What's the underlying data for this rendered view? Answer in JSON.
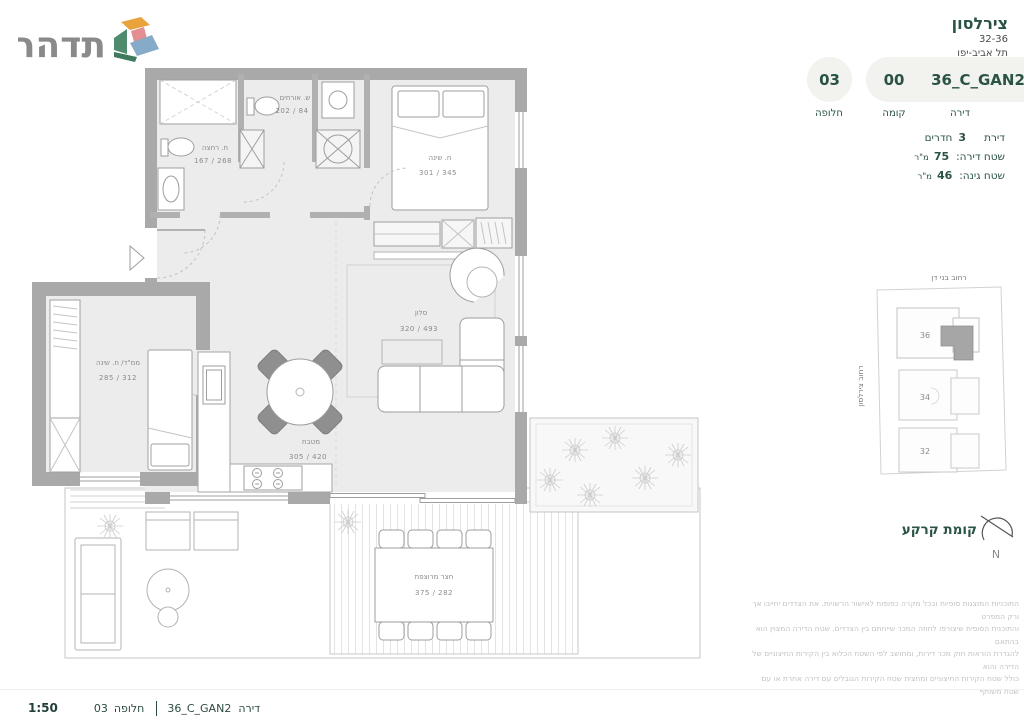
{
  "brand": {
    "logo_text": "תדהר"
  },
  "header": {
    "project_name": "צירלסון",
    "address_numbers": "32-36",
    "address_city": "תל אביב-יפו",
    "badges": {
      "alternative": {
        "value": "03",
        "label": "חלופה"
      },
      "floor": {
        "value": "00",
        "label": "קומה"
      },
      "apartment": {
        "value": "36_C_GAN2",
        "label": "דירה"
      }
    }
  },
  "details": {
    "rooms": {
      "prefix": "דירת",
      "value": "3",
      "suffix": "חדרים"
    },
    "apartment_area": {
      "label": "שטח דירה:",
      "value": "75",
      "unit": "מ\"ר"
    },
    "garden_area": {
      "label": "שטח גינה:",
      "value": "46",
      "unit": "מ\"ר"
    }
  },
  "floor_plan": {
    "rooms": {
      "bath": {
        "name": "ח. רחצה",
        "dims": "167 / 268"
      },
      "guest_wc": {
        "name": "ש. אורחים",
        "dims": "202 / 84"
      },
      "bedroom": {
        "name": "ח. שינה",
        "dims": "301 / 345"
      },
      "salon": {
        "name": "סלון",
        "dims": "320 / 493"
      },
      "kitchen": {
        "name": "מטבח",
        "dims": "305 / 420"
      },
      "mamad": {
        "name": "ממ\"ד/ ח. שינה",
        "dims": "285 / 312"
      },
      "courtyard": {
        "name": "חצר מרוצפת",
        "dims": "375 / 282"
      }
    }
  },
  "site_plan": {
    "street_top": "רחוב בני דן",
    "street_left": "רחוב צירלסון",
    "buildings": {
      "b36": "36",
      "b34": "34",
      "b32": "32"
    }
  },
  "floor_note": {
    "label": "קומת קרקע",
    "north": "N"
  },
  "disclaimer": [
    "התוכניות המוצגות סופיות ובכל מקרה כפופות לאישור הרשויות. את הצדדים יחייבו אך ורק המפרט",
    "והתוכנית הסופית שיצורפו לחוזה המכר שייחתם בין הצדדים. שטח הדירה המצוין הוא בהתאם",
    "להגדרת הוראות חוק מכר דירות, ומחושב לפי השטח הכלוא בין הקירות החיצוניים של הדירה והוא",
    "כולל שטח הקירות החיצוניים ומחצית שטח הקירות הגובלים עם דירה אחרת או עם שטח משותף"
  ],
  "footer": {
    "scale": "1:50",
    "alt_value": "03",
    "alt_label": "חלופה",
    "apt_value": "36_C_GAN2",
    "apt_label": "דירה"
  }
}
